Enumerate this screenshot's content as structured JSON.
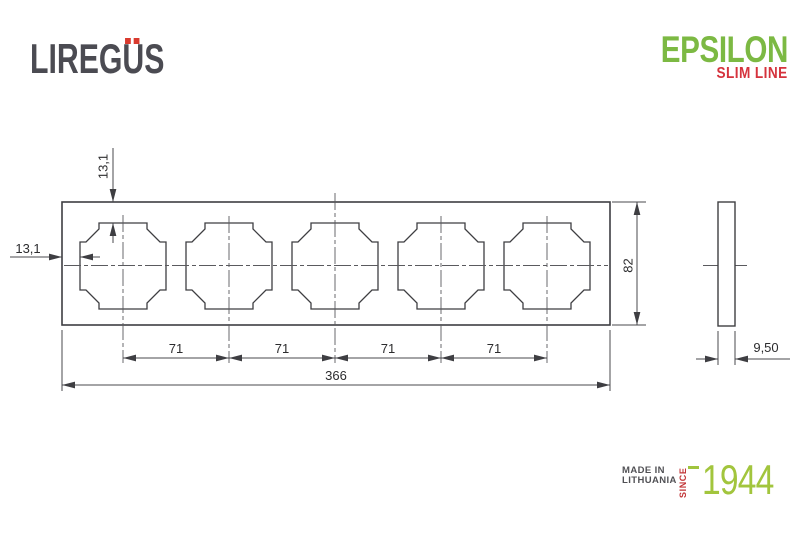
{
  "brand": {
    "name_display": "LIREGÜS",
    "name_before_umlaut": "LIREG",
    "umlaut_letter": "U",
    "name_after_umlaut": "S"
  },
  "product": {
    "name": "EPSILON",
    "series": "SLIM LINE"
  },
  "origin": {
    "made_in_line1": "MADE IN",
    "made_in_line2": "LITHUANIA",
    "since": "SINCE",
    "year": "1944"
  },
  "drawing": {
    "type": "technical-drawing",
    "views": [
      "front",
      "side"
    ],
    "gang_count": 5,
    "dimensions": {
      "frame_top_to_opening_top": "13,1",
      "frame_left_to_opening_left": "13,1",
      "opening_spacing": [
        "71",
        "71",
        "71",
        "71"
      ],
      "total_length": "366",
      "total_height": "82",
      "thickness": "9,50"
    }
  },
  "colors": {
    "brand_text": "#4b4b52",
    "accent_red": "#d93a2e",
    "epsilon_green": "#7cb943",
    "slim_line_red": "#d5333d",
    "year_green": "#a2c53d",
    "drawing_line": "#3e3e42"
  }
}
